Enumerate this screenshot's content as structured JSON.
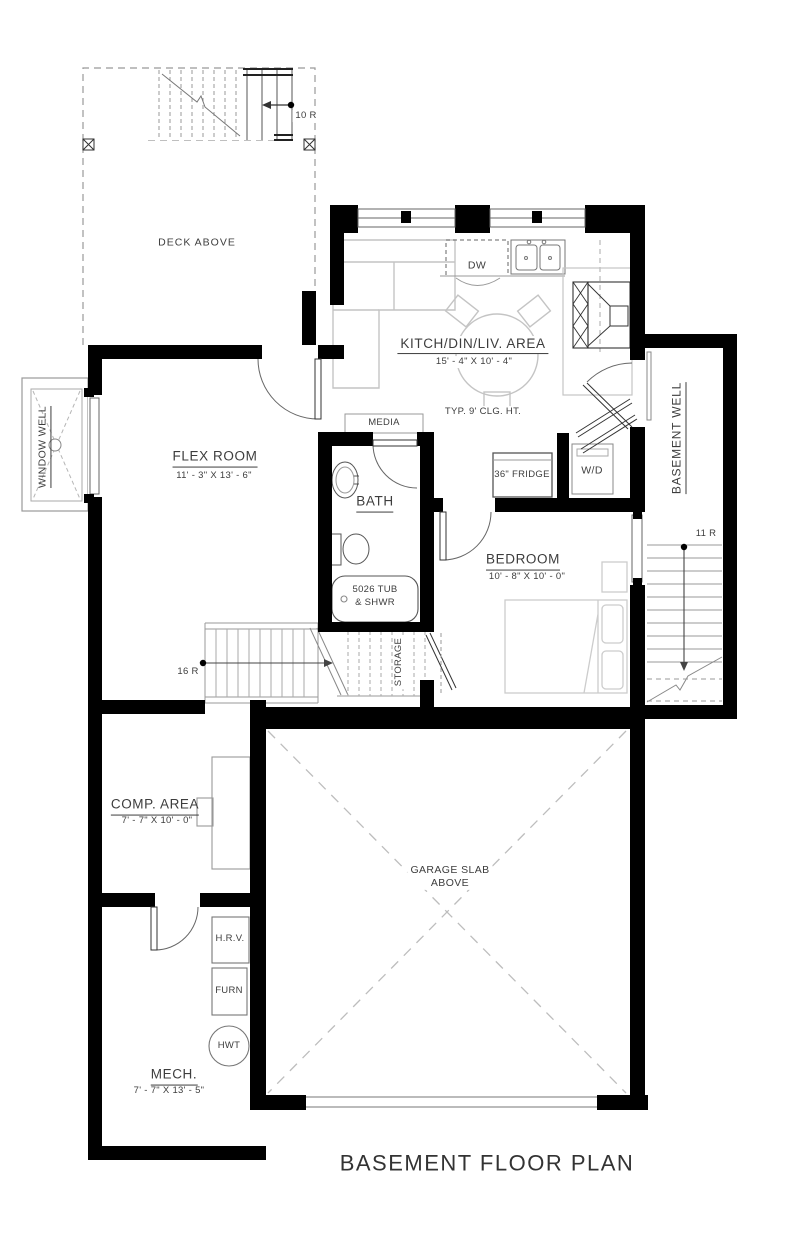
{
  "title": "BASEMENT FLOOR PLAN",
  "deck": {
    "label": "DECK ABOVE",
    "stair_risers": "10 R"
  },
  "kitchen": {
    "name": "KITCH/DIN/LIV. AREA",
    "dims": "15' - 4\" X 10' - 4\"",
    "ceiling_note": "TYP. 9' CLG. HT.",
    "dishwasher": "DW",
    "fridge": "36\" FRIDGE"
  },
  "flex": {
    "name": "FLEX ROOM",
    "dims": "11' - 3\" X 13' - 6\""
  },
  "window_well": {
    "label": "WINDOW WELL"
  },
  "media": {
    "label": "MEDIA"
  },
  "bath": {
    "name": "BATH",
    "tub_line1": "5026 TUB",
    "tub_line2": "& SHWR"
  },
  "laundry": {
    "label": "W/D"
  },
  "bedroom": {
    "name": "BEDROOM",
    "dims": "10' - 8\" X 10' - 0\""
  },
  "basement_well": {
    "label": "BASEMENT WELL",
    "stair_risers": "11 R"
  },
  "stairs": {
    "main_risers": "16 R",
    "storage_label": "STORAGE"
  },
  "comp": {
    "name": "COMP. AREA",
    "dims": "7' - 7\" X 10' - 0\""
  },
  "garage": {
    "line1": "GARAGE SLAB",
    "line2": "ABOVE"
  },
  "mech": {
    "name": "MECH.",
    "dims": "7' - 7\" X 13' - 5\"",
    "hrv": "H.R.V.",
    "furnace": "FURN",
    "water_tank": "HWT"
  },
  "colors": {
    "wall": "#000000",
    "thin_line": "#8a8a8a",
    "furniture": "#c4c4c4",
    "text": "#3d3d3d"
  }
}
